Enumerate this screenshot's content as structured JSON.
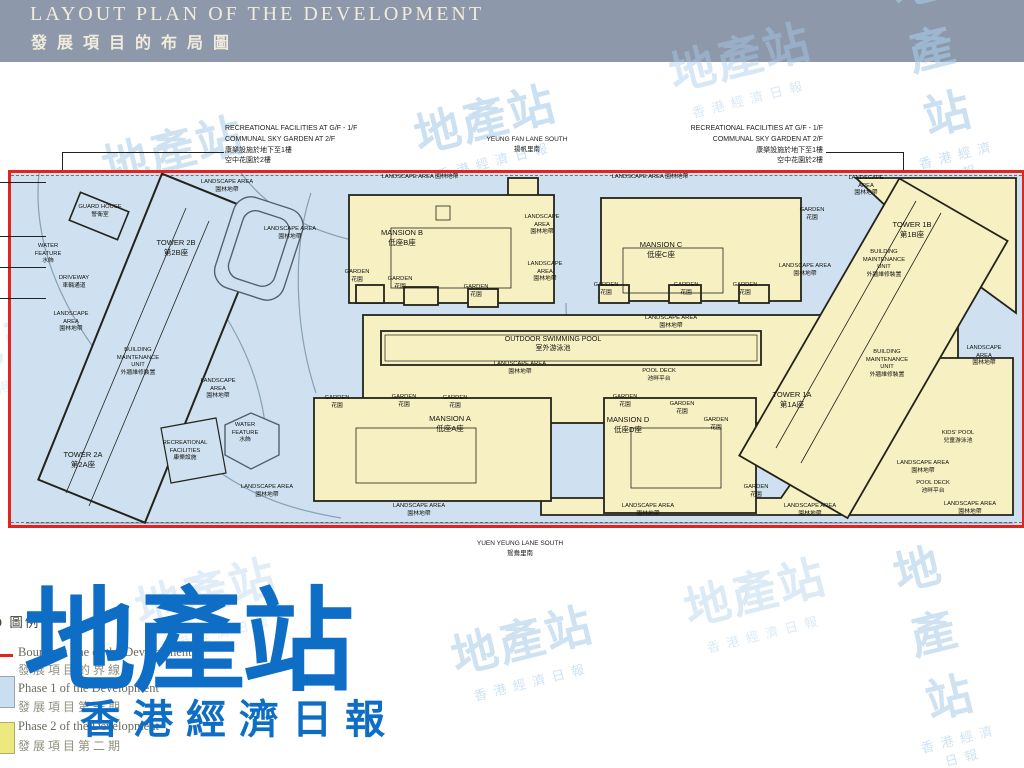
{
  "header": {
    "title_en": "LAYOUT PLAN OF THE DEVELOPMENT",
    "title_zh": "發展項目的布局圖",
    "bg_color": "#8d98ab",
    "text_color": "#f1ecda"
  },
  "annotations": {
    "top_left": {
      "lines": [
        "RECREATIONAL FACILITIES AT G/F - 1/F",
        "COMMUNAL SKY GARDEN AT 2/F",
        "康樂設施於地下至1樓",
        "空中花園於2樓"
      ]
    },
    "top_right": {
      "lines": [
        "RECREATIONAL FACILITIES AT G/F - 1/F",
        "COMMUNAL SKY GARDEN AT 2/F",
        "康樂設施於地下至1樓",
        "空中花園於2樓"
      ]
    },
    "street_top": {
      "en": "YEUNG FAN LANE SOUTH",
      "zh": "揚帆里南"
    },
    "street_bottom": {
      "en": "YUEN YEUNG LANE SOUTH",
      "zh": "鴛鴦里南"
    }
  },
  "plan": {
    "colors": {
      "water_bg": "#cfe1f0",
      "phase1_fill": "#cfe1f0",
      "phase2_fill": "#f6f0c2",
      "outline": "#23231b",
      "boundary_line": "#e3231e",
      "road": "#86a0b5"
    },
    "edge_ticks": [
      182,
      236,
      267,
      298
    ],
    "labels": [
      {
        "t": "GUARD HOUSE\n警衛室",
        "x": 100,
        "y": 204
      },
      {
        "t": "WATER\nFEATURE\n水飾",
        "x": 48,
        "y": 243
      },
      {
        "t": "DRIVEWAY\n車輛通道",
        "x": 74,
        "y": 275
      },
      {
        "t": "LANDSCAPE\nAREA\n園林地帶",
        "x": 71,
        "y": 311
      },
      {
        "t": "TOWER 2B\n第2B座",
        "x": 176,
        "y": 238,
        "s": 7.5
      },
      {
        "t": "TOWER 2A\n第2A座",
        "x": 83,
        "y": 450,
        "s": 7.5
      },
      {
        "t": "BUILDING\nMAINTENANCE\nUNIT\n外牆維修裝置",
        "x": 138,
        "y": 347
      },
      {
        "t": "RECREATIONAL\nFACILITIES\n康樂設施",
        "x": 185,
        "y": 440
      },
      {
        "t": "WATER\nFEATURE\n水飾",
        "x": 245,
        "y": 422
      },
      {
        "t": "LANDSCAPE AREA\n園林地帶",
        "x": 227,
        "y": 179
      },
      {
        "t": "LANDSCAPE\nAREA\n園林地帶",
        "x": 218,
        "y": 378
      },
      {
        "t": "LANDSCAPE AREA\n園林地帶",
        "x": 267,
        "y": 484
      },
      {
        "t": "LANDSCAPE AREA 園林地帶",
        "x": 420,
        "y": 174
      },
      {
        "t": "LANDSCAPE AREA\n園林地帶",
        "x": 290,
        "y": 226
      },
      {
        "t": "MANSION B\n低座B座",
        "x": 402,
        "y": 228,
        "s": 7.5
      },
      {
        "t": "GARDEN\n花園",
        "x": 357,
        "y": 269
      },
      {
        "t": "GARDEN\n花園",
        "x": 400,
        "y": 276
      },
      {
        "t": "GARDEN\n花園",
        "x": 476,
        "y": 284
      },
      {
        "t": "LANDSCAPE\nAREA\n園林地帶",
        "x": 542,
        "y": 214
      },
      {
        "t": "LANDSCAPE\nAREA\n園林地帶",
        "x": 545,
        "y": 261
      },
      {
        "t": "LANDSCAPE AREA 園林地帶",
        "x": 650,
        "y": 174
      },
      {
        "t": "MANSION C\n低座C座",
        "x": 661,
        "y": 240,
        "s": 7.5
      },
      {
        "t": "GARDEN\n花園",
        "x": 606,
        "y": 282
      },
      {
        "t": "GARDEN\n花園",
        "x": 686,
        "y": 282
      },
      {
        "t": "GARDEN\n花園",
        "x": 745,
        "y": 282
      },
      {
        "t": "GARDEN\n花園",
        "x": 812,
        "y": 207
      },
      {
        "t": "LANDSCAPE AREA\n園林地帶",
        "x": 805,
        "y": 263
      },
      {
        "t": "LANDSCAPE\nAREA\n園林地帶",
        "x": 866,
        "y": 175
      },
      {
        "t": "TOWER 1B\n第1B座",
        "x": 912,
        "y": 220,
        "s": 7.5
      },
      {
        "t": "BUILDING\nMAINTENANCE\nUNIT\n外牆維修裝置",
        "x": 884,
        "y": 249
      },
      {
        "t": "OUTDOOR SWIMMING POOL\n室外游泳池",
        "x": 553,
        "y": 335,
        "s": 7
      },
      {
        "t": "LANDSCAPE AREA\n園林地帶",
        "x": 520,
        "y": 361
      },
      {
        "t": "POOL DECK\n池畔平台",
        "x": 659,
        "y": 368
      },
      {
        "t": "LANDSCAPE AREA\n園林地帶",
        "x": 671,
        "y": 315
      },
      {
        "t": "MANSION A\n低座A座",
        "x": 450,
        "y": 414,
        "s": 7.5
      },
      {
        "t": "GARDEN\n花園",
        "x": 337,
        "y": 395
      },
      {
        "t": "GARDEN\n花園",
        "x": 404,
        "y": 394
      },
      {
        "t": "GARDEN\n花園",
        "x": 455,
        "y": 395
      },
      {
        "t": "LANDSCAPE AREA\n園林地帶",
        "x": 419,
        "y": 503
      },
      {
        "t": "MANSION D\n低座D座",
        "x": 628,
        "y": 415,
        "s": 7.5
      },
      {
        "t": "GARDEN\n花園",
        "x": 625,
        "y": 394
      },
      {
        "t": "GARDEN\n花園",
        "x": 682,
        "y": 401
      },
      {
        "t": "GARDEN\n花園",
        "x": 716,
        "y": 417
      },
      {
        "t": "GARDEN\n花園",
        "x": 756,
        "y": 484
      },
      {
        "t": "LANDSCAPE AREA\n園林地帶",
        "x": 648,
        "y": 503
      },
      {
        "t": "TOWER 1A\n第1A座",
        "x": 792,
        "y": 390,
        "s": 7.5
      },
      {
        "t": "BUILDING\nMAINTENANCE\nUNIT\n外牆維修裝置",
        "x": 887,
        "y": 349
      },
      {
        "t": "LANDSCAPE AREA\n園林地帶",
        "x": 984,
        "y": 345
      },
      {
        "t": "KIDS' POOL\n兒童游泳池",
        "x": 958,
        "y": 430
      },
      {
        "t": "LANDSCAPE AREA\n園林地帶",
        "x": 923,
        "y": 460
      },
      {
        "t": "POOL DECK\n池畔平台",
        "x": 933,
        "y": 480
      },
      {
        "t": "LANDSCAPE AREA\n園林地帶",
        "x": 970,
        "y": 501
      },
      {
        "t": "LANDSCAPE AREA\n園林地帶",
        "x": 810,
        "y": 503
      }
    ]
  },
  "legend": {
    "title": "LEGEND 圖例",
    "items": [
      {
        "en": "Boundary line of the Development",
        "zh": "發展項目的界線",
        "swatch_color": "#e3231e",
        "swatch_type": "line"
      },
      {
        "en": "Phase 1 of the Development",
        "zh": "發展項目第一期",
        "swatch_color": "#c9dff0",
        "swatch_type": "fill"
      },
      {
        "en": "Phase 2 of the Development",
        "zh": "發展項目第二期",
        "swatch_color": "#ece97e",
        "swatch_type": "fill"
      }
    ]
  },
  "logo": {
    "text": "地產站",
    "subtext": "香港經濟日報",
    "color": "#0e6dc5"
  },
  "watermarks": {
    "text": "地產站",
    "subtext": "香港經濟日報",
    "color": "#a9cce9",
    "positions": [
      {
        "x": 175,
        "y": 158,
        "o": 0.55
      },
      {
        "x": 487,
        "y": 127,
        "o": 0.6
      },
      {
        "x": 742,
        "y": 65,
        "o": 0.45
      },
      {
        "x": 936,
        "y": 66,
        "o": 0.6
      },
      {
        "x": 978,
        "y": 292,
        "o": 0.55
      },
      {
        "x": 500,
        "y": 345,
        "o": 0.4
      },
      {
        "x": 28,
        "y": 345,
        "o": 0.3
      },
      {
        "x": 208,
        "y": 600,
        "o": 0.35
      },
      {
        "x": 524,
        "y": 648,
        "o": 0.55
      },
      {
        "x": 757,
        "y": 600,
        "o": 0.4
      },
      {
        "x": 938,
        "y": 650,
        "o": 0.55
      }
    ]
  }
}
